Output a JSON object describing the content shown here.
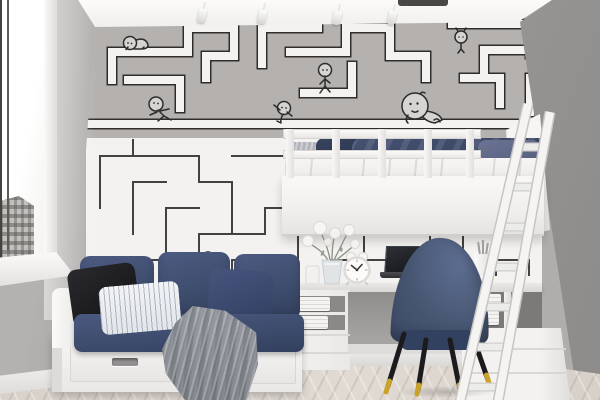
{
  "scene": {
    "label": "Photorealistic render of a kids bedroom with maze-doodle wallpaper, white loft bed, navy daybed sofa, desk with laptop and blue velvet chair",
    "type": "interior-photo"
  },
  "palette": {
    "wall_gray": "#a9a7a5",
    "wallpaper_gray": "#b4b1ae",
    "wallpaper_white": "#f3f2f0",
    "maze_line": "#3f3f3f",
    "navy": "#3d4a6c",
    "navy_dark": "#2e3850",
    "furniture_white": "#f4f3f2",
    "floor_wood": "#ddd6cf",
    "throw_gray": "#8e9298",
    "brass": "#c9a227",
    "pillow_black": "#1f1f22"
  },
  "objects": {
    "window": {
      "label": "Bright window with city view and white frame"
    },
    "windowsill": {
      "label": "White windowsill"
    },
    "city_view": {
      "label": "Gray building seen through window"
    },
    "ceiling": {
      "label": "White ceiling"
    },
    "track_light": {
      "label": "Ceiling track with four white spotlights",
      "spot_count": 4
    },
    "recessed_light": {
      "label": "Dark recessed light slot"
    },
    "wallpaper": {
      "label": "Maze wallpaper: gray upper band with white outlined paths, white lower band with thin dark maze lines",
      "figures": [
        "crawling",
        "pushing",
        "climbing",
        "walking",
        "sitting-large",
        "hanging",
        "peeking"
      ]
    },
    "right_wall": {
      "label": "Plain gray side wall"
    },
    "floor": {
      "label": "Light herringbone wood floor"
    },
    "loft_bed": {
      "label": "White loft bed with railing, navy bedding and headboard"
    },
    "bed_railing": {
      "label": "White safety railing with posts",
      "post_count": 5
    },
    "bed_duvet": {
      "label": "Navy duvet and pillows"
    },
    "bed_mattress": {
      "label": "White mattress and sheet"
    },
    "ladder": {
      "label": "White leaning ladder to loft bed",
      "rung_count": 7
    },
    "desk": {
      "label": "White built-in desk with open shelving"
    },
    "laptop": {
      "label": "Open dark laptop"
    },
    "alarm_clock": {
      "label": "White twin-bell alarm clock reading about 10:10"
    },
    "flower_vase": {
      "label": "Glass vase with white flowers"
    },
    "pencil_cup": {
      "label": "White cup with pencils"
    },
    "shelf_stacks": {
      "label": "Folded white textiles on open shelves",
      "stack_count": 4
    },
    "cabinet": {
      "label": "White cabinet with drawers under the loft bed"
    },
    "sofa": {
      "label": "White daybed sofa with navy cushions and two storage drawers",
      "drawer_count": 2
    },
    "pillow_black": {
      "label": "Black throw pillow"
    },
    "pillow_striped": {
      "label": "White pinstriped lumbar pillow"
    },
    "pillow_navy": {
      "label": "Navy throw pillow"
    },
    "throw_blanket": {
      "label": "Gray knit throw blanket draped over sofa"
    },
    "chair": {
      "label": "Blue velvet chair with black tapered legs and brass tips"
    },
    "baseboard": {
      "label": "White baseboard"
    }
  }
}
